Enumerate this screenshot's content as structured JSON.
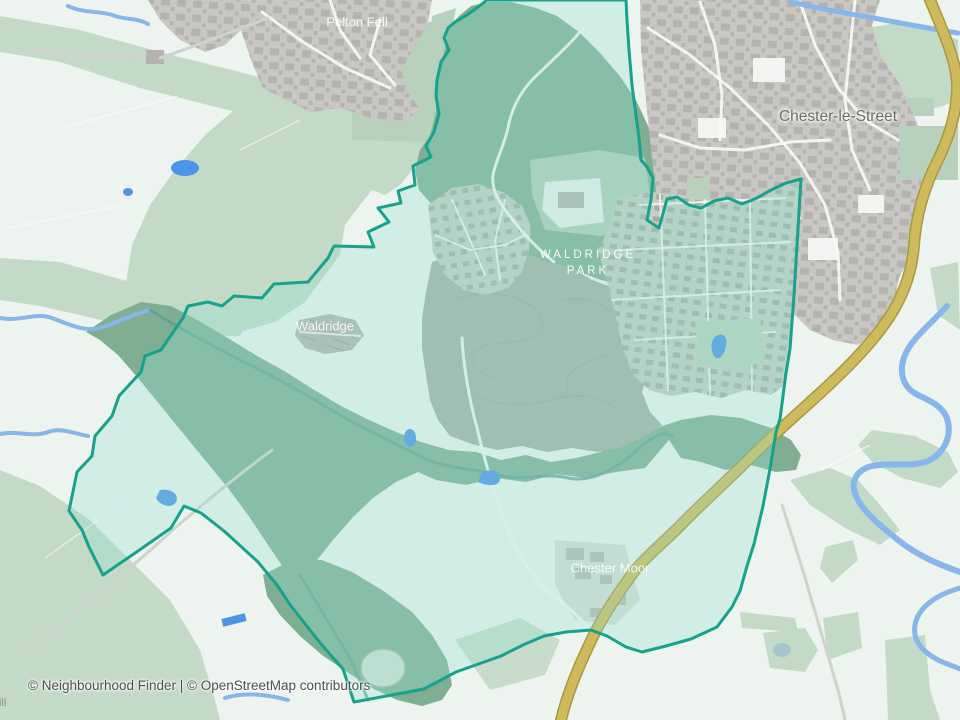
{
  "title": "Neighbourhood boundary map",
  "labels": {
    "pelton_fell": "Pelton Fell",
    "chester_le_street": "Chester-le-Street",
    "waldridge_park_line1": "WALDRIDGE",
    "waldridge_park_line2": "PARK",
    "waldridge": "Waldridge",
    "chester_moor": "Chester Moor",
    "hill_partial": "Hill"
  },
  "attribution": {
    "text": "© Neighbourhood Finder | © OpenStreetMap contributors"
  },
  "colors": {
    "map-bg": "#edf4ef",
    "field-sage": "#c3dac7",
    "field-sage-dark": "#b7d1bc",
    "woodland": "#7fae93",
    "moorland": "#a6b0a4",
    "contour": "#94a396",
    "urban-base": "#c8c7c3",
    "building": "#b4b3af",
    "estate-base": "#c3cdc2",
    "estate-house": "#a7aba2",
    "road-white": "#f7f8f5",
    "road-gray": "#cfd3ce",
    "road-a-casing": "#a89840",
    "road-a-fill": "#ccba5c",
    "river": "#87b6ea",
    "pond": "#4d93e8",
    "stream": "#609f90",
    "boundary-stroke": "#16a28c",
    "boundary-fill": "rgba(150,225,210,0.32)",
    "label-white": "#ffffff",
    "label-gray": "#6d6d6d",
    "attribution-text": "#4f4f4f"
  }
}
